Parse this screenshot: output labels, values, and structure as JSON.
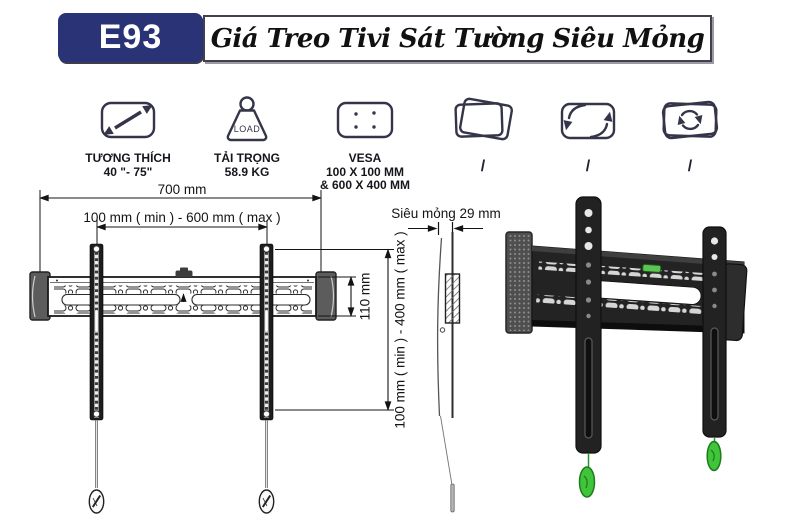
{
  "header": {
    "model": "E93",
    "title": "Giá Treo Tivi Sát Tường Siêu Mỏng"
  },
  "features": [
    {
      "name": "compatibility",
      "icon": "screen-size-diagonal-icon",
      "lines": [
        "TƯƠNG THÍCH",
        "40 \"- 75\""
      ]
    },
    {
      "name": "load",
      "icon": "weight-icon",
      "icon_text": "LOAD",
      "lines": [
        "TẢI TRỌNG",
        "58.9 KG"
      ]
    },
    {
      "name": "vesa",
      "icon": "vesa-plate-icon",
      "lines": [
        "VESA",
        "100 X 100 MM",
        "& 600 X 400 MM"
      ]
    },
    {
      "name": "swivel",
      "icon": "swivel-screen-icon",
      "lines": [
        "/"
      ]
    },
    {
      "name": "tilt",
      "icon": "tilt-arrows-icon",
      "lines": [
        "/"
      ]
    },
    {
      "name": "rotate",
      "icon": "rotate-screen-icon",
      "lines": [
        "/"
      ]
    }
  ],
  "dimensions": {
    "total_width": "700 mm",
    "arm_spacing": "100 mm ( min ) - 600 mm ( max )",
    "rail_height": "110 mm",
    "vesa_height": "100 mm ( min ) - 400 mm ( max )",
    "profile": "Siêu mỏng 29 mm"
  },
  "colors": {
    "brand_navy": "#2a3376",
    "bracket_black": "#1d1d1d",
    "highlight_green": "#3fc43a"
  }
}
